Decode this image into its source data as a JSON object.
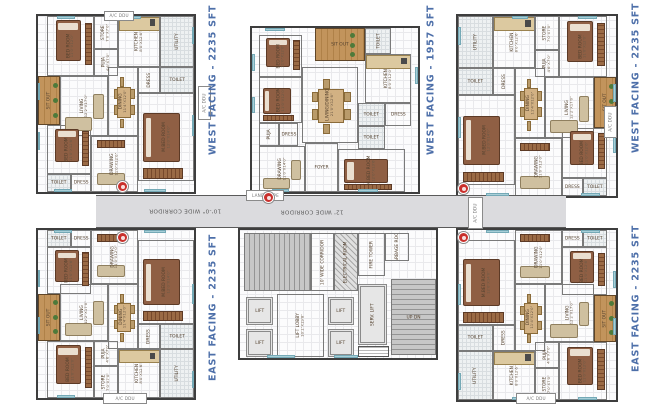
{
  "palette": {
    "label_blue": "#4d6fa9",
    "wall": "#3e3e3e",
    "corridor_fill": "#dbdbde",
    "wood": "#c2945c",
    "bed_brown": "#8f5f44",
    "window_blue": "#a8cfd8",
    "marker_red": "#c9302c",
    "stairs_gray": "#949494"
  },
  "unit_labels": [
    {
      "text": "WEST FACING - 2235 SFT",
      "x": 213,
      "y": 80
    },
    {
      "text": "WEST FACING - 1957 SFT",
      "x": 431,
      "y": 80
    },
    {
      "text": "WEST FACING - 2235 SFT",
      "x": 636,
      "y": 78
    },
    {
      "text": "EAST FACING - 2235 SFT",
      "x": 213,
      "y": 307
    },
    {
      "text": "EAST FACING - 2235 SFT",
      "x": 636,
      "y": 298
    }
  ],
  "corridor": {
    "box": [
      96,
      195,
      470,
      33
    ],
    "labels": [
      {
        "text": "10'-0\" WIDE CORRIDOR",
        "x": 185,
        "y": 207
      },
      {
        "text": "12' WIDE CORRIDOR",
        "x": 312,
        "y": 208
      }
    ]
  },
  "entry_markers": [
    [
      122,
      186
    ],
    [
      268,
      197
    ],
    [
      463,
      188
    ],
    [
      122,
      237
    ],
    [
      463,
      237
    ]
  ],
  "deck_boxes": [
    {
      "label": "A/C DDU",
      "x": 104,
      "y": 11,
      "w": 30,
      "h": 10,
      "vert": false
    },
    {
      "label": "A/C DDU",
      "x": 198,
      "y": 86,
      "w": 13,
      "h": 34,
      "vert": true
    },
    {
      "label": "LANDSCAPE",
      "x": 246,
      "y": 190,
      "w": 38,
      "h": 11,
      "vert": false
    },
    {
      "label": "A/C DDU",
      "x": 468,
      "y": 197,
      "w": 15,
      "h": 32,
      "vert": true
    },
    {
      "label": "A/C DDU",
      "x": 604,
      "y": 106,
      "w": 13,
      "h": 32,
      "vert": true
    },
    {
      "label": "A/C DDU",
      "x": 103,
      "y": 393,
      "w": 44,
      "h": 11,
      "vert": false
    },
    {
      "label": "A/C DDU",
      "x": 516,
      "y": 393,
      "w": 40,
      "h": 11,
      "vert": false
    }
  ],
  "units": [
    {
      "id": "west-2235-a",
      "layout": "l2235",
      "mx": false,
      "my": false,
      "box": [
        36,
        14,
        160,
        180
      ]
    },
    {
      "id": "west-1957",
      "layout": "l1957",
      "mx": false,
      "my": false,
      "box": [
        250,
        26,
        170,
        168
      ]
    },
    {
      "id": "west-2235-b",
      "layout": "l2235",
      "mx": true,
      "my": false,
      "box": [
        456,
        14,
        162,
        184
      ]
    },
    {
      "id": "east-2235-a",
      "layout": "l2235",
      "mx": false,
      "my": true,
      "box": [
        36,
        228,
        160,
        172
      ]
    },
    {
      "id": "east-2235-b",
      "layout": "l2235",
      "mx": true,
      "my": true,
      "box": [
        456,
        228,
        162,
        174
      ]
    },
    {
      "id": "core",
      "layout": "lcore",
      "mx": false,
      "my": false,
      "box": [
        238,
        228,
        200,
        132
      ],
      "core": true
    }
  ],
  "layouts": {
    "l2235": {
      "rooms": [
        {
          "n": "BED ROOM",
          "d": "11'0\"X12'0\"",
          "x": 6,
          "y": 0,
          "w": 30,
          "h": 34,
          "fur": "bed-v",
          "vert": true
        },
        {
          "n": "STORE",
          "d": "7'0\"X7'0\"",
          "x": 36,
          "y": 0,
          "w": 15,
          "h": 19,
          "vert": true
        },
        {
          "n": "PUJA",
          "d": "4'6\"X7'0\"",
          "x": 36,
          "y": 19,
          "w": 15,
          "h": 15,
          "vert": true
        },
        {
          "n": "KITCHEN",
          "d": "8'0\"X12'6\"",
          "x": 51,
          "y": 0,
          "w": 27,
          "h": 29,
          "fur": "counter",
          "vert": true
        },
        {
          "n": "UTILITY",
          "x": 78,
          "y": 0,
          "w": 22,
          "h": 29,
          "fill": "tile",
          "vert": true
        },
        {
          "n": "TOILET",
          "x": 78,
          "y": 29,
          "w": 22,
          "h": 15,
          "fill": "tile"
        },
        {
          "n": "DRESS",
          "x": 64,
          "y": 29,
          "w": 14,
          "h": 15,
          "vert": true
        },
        {
          "n": "SIT OUT",
          "x": 0,
          "y": 34,
          "w": 14,
          "h": 28,
          "fill": "wood",
          "vert": true
        },
        {
          "n": "LIVING",
          "d": "12'2\"X17'0\"",
          "x": 14,
          "y": 34,
          "w": 31,
          "h": 34,
          "fur": "sofa",
          "vert": true
        },
        {
          "n": "DINING",
          "d": "11'4\"X12'0\"",
          "x": 45,
          "y": 29,
          "w": 19,
          "h": 39,
          "fur": "table",
          "vert": true
        },
        {
          "n": "M.BED ROOM",
          "d": "12'0\"X14'0\"",
          "x": 64,
          "y": 44,
          "w": 36,
          "h": 50,
          "fur": "bed-h",
          "vert": true
        },
        {
          "n": "BED ROOM",
          "d": "11'0\"X12'6\"",
          "x": 6,
          "y": 62,
          "w": 28,
          "h": 28,
          "fur": "bed-v",
          "vert": true
        },
        {
          "n": "TOILET",
          "x": 6,
          "y": 90,
          "w": 15,
          "h": 10,
          "fill": "tile"
        },
        {
          "n": "DRESS",
          "x": 21,
          "y": 90,
          "w": 13,
          "h": 10
        },
        {
          "n": "DRAWING",
          "d": "11'0\"X12'0\"",
          "x": 34,
          "y": 68,
          "w": 30,
          "h": 32,
          "fur": "sofa2",
          "vert": true
        }
      ],
      "windows": [
        [
          12,
          0,
          12,
          1.6
        ],
        [
          56,
          0,
          10,
          1.6
        ],
        [
          0,
          38,
          1.6,
          10
        ],
        [
          0,
          66,
          1.6,
          10
        ],
        [
          10,
          98.4,
          12,
          1.6
        ],
        [
          68,
          98.4,
          14,
          1.6
        ],
        [
          98.4,
          56,
          1.6,
          12
        ],
        [
          98.4,
          6,
          1.6,
          10
        ]
      ]
    },
    "l1957": {
      "rooms": [
        {
          "n": "BED ROOM",
          "d": "11'0\"X12'0\"",
          "x": 4,
          "y": 4,
          "w": 26,
          "h": 26,
          "fur": "bed-v",
          "vert": true
        },
        {
          "n": "SIT OUT",
          "x": 38,
          "y": 0,
          "w": 30,
          "h": 20,
          "fill": "wood"
        },
        {
          "n": "TOILET",
          "x": 68,
          "y": 0,
          "w": 16,
          "h": 16,
          "fill": "tile",
          "vert": true
        },
        {
          "n": "KITCHEN",
          "d": "8'0\"X12'0\"",
          "x": 68,
          "y": 16,
          "w": 28,
          "h": 30,
          "fur": "counter",
          "vert": true
        },
        {
          "n": "BED ROOM",
          "d": "11'0\"X12'0\"",
          "x": 4,
          "y": 30,
          "w": 26,
          "h": 28,
          "fur": "bed-h",
          "vert": true
        },
        {
          "n": "LIVING/DINING",
          "d": "21'0\"X12'6\"",
          "x": 30,
          "y": 24,
          "w": 34,
          "h": 46,
          "fur": "table",
          "vert": true
        },
        {
          "n": "TOILET",
          "x": 64,
          "y": 46,
          "w": 16,
          "h": 14,
          "fill": "tile"
        },
        {
          "n": "DRESS",
          "x": 80,
          "y": 46,
          "w": 16,
          "h": 14
        },
        {
          "n": "PUJA",
          "x": 4,
          "y": 58,
          "w": 12,
          "h": 14,
          "vert": true
        },
        {
          "n": "DRESS",
          "x": 16,
          "y": 58,
          "w": 12,
          "h": 14
        },
        {
          "n": "TOILET",
          "x": 64,
          "y": 60,
          "w": 16,
          "h": 14,
          "fill": "tile"
        },
        {
          "n": "DRAWING",
          "d": "11'0\"X14'0\"",
          "x": 4,
          "y": 72,
          "w": 28,
          "h": 28,
          "fur": "sofa",
          "vert": true
        },
        {
          "n": "FOYER",
          "x": 32,
          "y": 70,
          "w": 20,
          "h": 30
        },
        {
          "n": "M.BED ROOM",
          "d": "12'0\"X13'6\"",
          "x": 52,
          "y": 74,
          "w": 40,
          "h": 26,
          "fur": "bed-h",
          "vert": true
        }
      ],
      "windows": [
        [
          8,
          0,
          12,
          1.8
        ],
        [
          98.2,
          24,
          1.8,
          10
        ],
        [
          0,
          16,
          1.8,
          10
        ],
        [
          0,
          42,
          1.8,
          10
        ],
        [
          12,
          98.2,
          10,
          1.8
        ],
        [
          64,
          98.2,
          12,
          1.8
        ]
      ]
    },
    "lcore": {
      "rooms": [
        {
          "n": "",
          "x": 2,
          "y": 2,
          "w": 34,
          "h": 46,
          "fill": "stairs-h"
        },
        {
          "n": "LIFT",
          "x": 3,
          "y": 52,
          "w": 14,
          "h": 22,
          "fill": "lift"
        },
        {
          "n": "LIFT",
          "x": 3,
          "y": 77,
          "w": 14,
          "h": 22,
          "fill": "lift"
        },
        {
          "n": "LIFT LOBBY",
          "d": "10'1\"X19'8\"",
          "x": 19,
          "y": 50,
          "w": 24,
          "h": 49,
          "vert": true
        },
        {
          "n": "10' WIDE CORRIDOR",
          "x": 36,
          "y": 2,
          "w": 12,
          "h": 46,
          "vert": true
        },
        {
          "n": "ELECTRICAL ROOM",
          "x": 48,
          "y": 2,
          "w": 12,
          "h": 46,
          "fill": "hatch",
          "vert": true
        },
        {
          "n": "FIRE TOWER",
          "x": 60,
          "y": 2,
          "w": 14,
          "h": 34,
          "vert": true
        },
        {
          "n": "GARBAGE ROOM",
          "x": 74,
          "y": 2,
          "w": 12,
          "h": 22,
          "vert": true
        },
        {
          "n": "LIFT",
          "x": 45,
          "y": 52,
          "w": 13,
          "h": 22,
          "fill": "lift"
        },
        {
          "n": "LIFT",
          "x": 45,
          "y": 77,
          "w": 13,
          "h": 22,
          "fill": "lift"
        },
        {
          "n": "SERV. LIFT",
          "x": 60,
          "y": 42,
          "w": 15,
          "h": 48,
          "fill": "lift",
          "vert": true
        },
        {
          "n": "UP   DN",
          "x": 77,
          "y": 38,
          "w": 23,
          "h": 60,
          "fill": "stairs-v"
        },
        {
          "n": "",
          "x": 60,
          "y": 91,
          "w": 16,
          "h": 8,
          "fill": "note"
        }
      ],
      "windows": [
        [
          14,
          98,
          14,
          2
        ],
        [
          48,
          98,
          12,
          2
        ]
      ]
    }
  }
}
